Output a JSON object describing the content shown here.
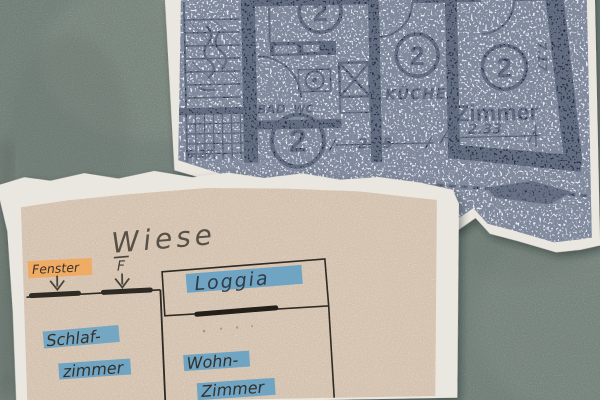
{
  "colors": {
    "background": "#7d9188",
    "torn_paper_white": "#eae7e0",
    "plan_paper": "#e7ecf3",
    "plan_ink": "#2a3144",
    "sketch_paper": "#ecd7c3",
    "pencil": "#4a443b",
    "highlight_orange": "#f2a95c",
    "highlight_blue": "#5d9fc6"
  },
  "floorplan": {
    "room_numbers": [
      "2",
      "2",
      "2",
      "2"
    ],
    "labels": {
      "bad": "BAD",
      "wc": "WC",
      "kueche": "KÜCHE",
      "zimmer": "Zimmer"
    },
    "dimensions": {
      "kueche_width": "2.85",
      "zimmer_width": "2.33",
      "zimmer_depth": "7.17",
      "stair_edge": "6.27"
    }
  },
  "sketch": {
    "title": "Wiese",
    "window_label": "Fenster",
    "window_marker": "F",
    "loggia_label": "Loggia",
    "schlafzimmer_line1": "Schlaf-",
    "schlafzimmer_line2": "zimmer",
    "wohnzimmer_line1": "Wohn-",
    "wohnzimmer_line2": "Zimmer"
  }
}
